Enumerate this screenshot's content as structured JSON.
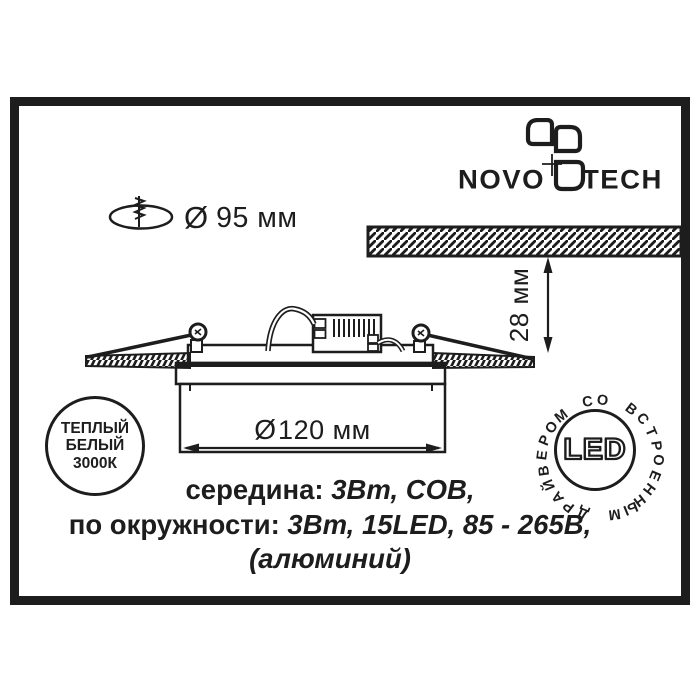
{
  "brand": {
    "name_left": "NOVO",
    "name_right": "TECH"
  },
  "hole_dimension": {
    "symbol": "Ø",
    "value": "95 мм"
  },
  "cutout_depth": {
    "value": "28 мм"
  },
  "fixture_diameter": {
    "symbol": "Ø",
    "value": "120 мм"
  },
  "color_badge": {
    "line1": "ТЕПЛЫЙ",
    "line2": "БЕЛЫЙ",
    "line3": "3000К"
  },
  "led_badge": {
    "center_label": "LED",
    "ring_text": "ДРАЙВЕРОМ СО ВСТРОЕННЫМ"
  },
  "specs": {
    "line1_label": "середина:",
    "line1_value": " 3Вт, COB,",
    "line2_label": "по окружности:",
    "line2_value": " 3Вт, 15LED, 85 - 265В,",
    "line3_value": "(алюминий)"
  },
  "colors": {
    "ink": "#1d1d1d",
    "paper": "#ffffff"
  }
}
